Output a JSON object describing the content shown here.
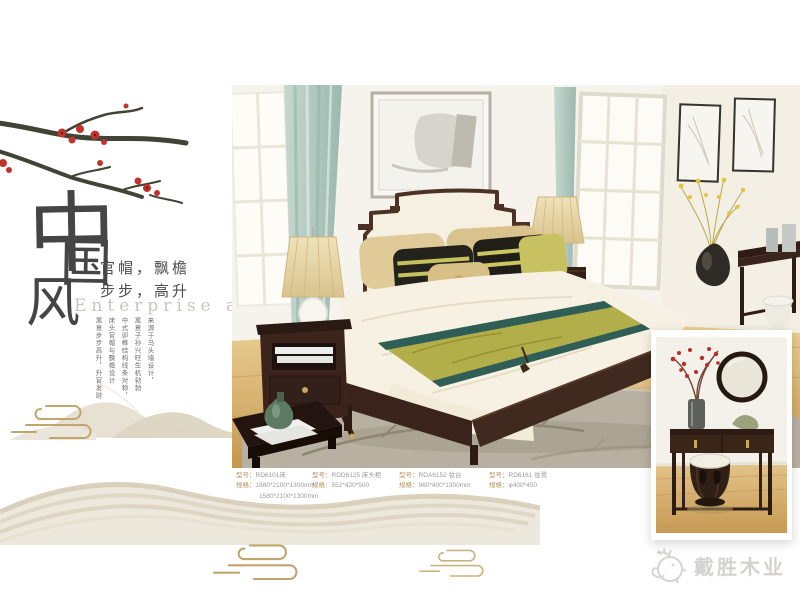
{
  "left_panel": {
    "title_chars": [
      "中",
      "国",
      "风"
    ],
    "tagline_line1": "官帽，飘檐",
    "tagline_line2": "步步，高升",
    "english_title": "Enterprise  album",
    "vertical_text": [
      "来源于马头墙设计，",
      "寓意子孙兴旺生机勃勃",
      "中式卯榫结构线条对称，",
      "床头官帽与飘檐设计",
      "寓意步步高升，升官发财"
    ]
  },
  "products": [
    {
      "model_label": "型号：",
      "model": "RD6101床",
      "spec_label": "规格：",
      "spec": "1880*2100*1300mm",
      "spec2": "1580*2100*1300mm"
    },
    {
      "model_label": "型号：",
      "model": "RDD6125 床头柜",
      "spec_label": "规格：",
      "spec": "552*420*500"
    },
    {
      "model_label": "型号：",
      "model": "RDA6152 妆台",
      "spec_label": "规格：",
      "spec": "960*400*1300mm"
    },
    {
      "model_label": "型号：",
      "model": "RD6161 妆凳",
      "spec_label": "规格：",
      "spec": "φ400*450"
    }
  ],
  "logo": {
    "text": "戴胜木业"
  },
  "palette": {
    "blossom_red": "#c1342c",
    "branch_green": "#3f4436",
    "cloud_gold": "#c0a66c",
    "mountain_tan": "#ddd5c3",
    "spec_label_gold": "#b4945e",
    "spec_value_gray": "#9b9b9b",
    "bed_wood": "#3a241c",
    "runner_green": "#b2ae49",
    "runner_teal": "#2f5e57",
    "curtain_teal": "#aec9c0",
    "floor_wood": "#d8b374",
    "rug_gray": "#b8b1a1",
    "logo_gray": "#d3d2d0"
  }
}
